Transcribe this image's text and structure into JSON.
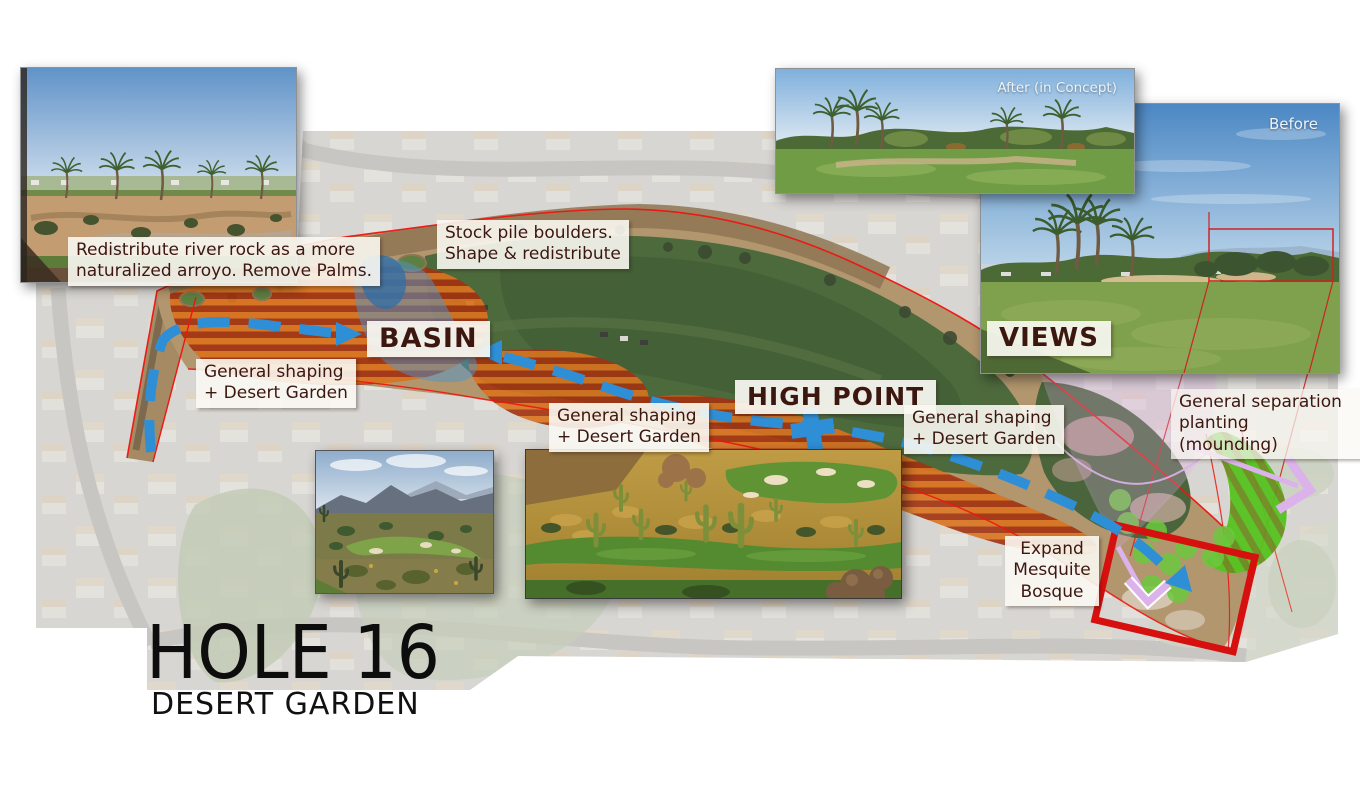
{
  "title": {
    "main": "HOLE 16",
    "subtitle": "DESERT GARDEN"
  },
  "plan_labels": {
    "redistribute": "Redistribute river rock as a more\nnaturalized arroyo.  Remove Palms.",
    "stockpile": "Stock pile boulders.\nShape & redistribute",
    "basin": "BASIN",
    "high_point": "HIGH POINT",
    "general_shaping": [
      "General shaping\n+ Desert Garden",
      "General shaping\n+ Desert Garden",
      "General shaping\n+ Desert Garden"
    ],
    "separation": "General separation\nplanting (mounding)",
    "expand_bosque": "Expand\nMesquite\nBosque",
    "views": "VIEWS"
  },
  "photo_labels": {
    "after": "After (in Concept)",
    "before": "Before"
  },
  "legend_colors": {
    "desert_garden_stripes_orange": "#d9731f",
    "desert_garden_stripes_red": "#a23210",
    "flow_arrow_blue": "#2e8ed6",
    "hole_boundary_red": "#ef1410",
    "bosque_box_red": "#d60f0f",
    "separation_planting_green": "#55c21f",
    "separation_planting_green_dark": "#6e8c21",
    "mesquite_dots_green": "#6cc93e",
    "view_cone_pink": "#dcb2ea",
    "basin_overlay_blue": "#4f94c9"
  }
}
